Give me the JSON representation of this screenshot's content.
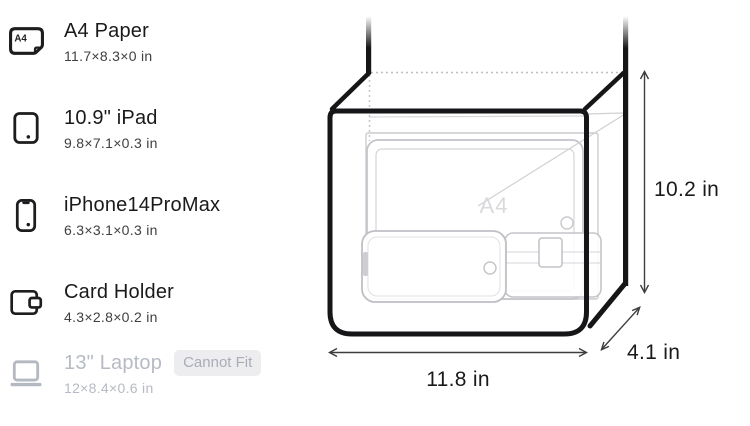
{
  "items": [
    {
      "name": "A4 Paper",
      "dims": "11.7×8.3×0 in",
      "icon_label": "A4"
    },
    {
      "name": "10.9\" iPad",
      "dims": "9.8×7.1×0.3 in"
    },
    {
      "name": "iPhone14ProMax",
      "dims": "6.3×3.1×0.3 in"
    },
    {
      "name": "Card Holder",
      "dims": "4.3×2.8×0.2 in"
    },
    {
      "name": "13\" Laptop",
      "dims": "12×8.4×0.6 in",
      "badge": "Cannot Fit"
    }
  ],
  "diagram": {
    "watermark": "A4",
    "height_label": "10.2 in",
    "width_label": "11.8 in",
    "depth_label": "4.1 in"
  },
  "colors": {
    "ink": "#161618",
    "ghost_stroke": "#c6c6cb",
    "muted_text": "#b6bac2",
    "badge_bg": "#ededf0",
    "badge_text": "#a8adb7"
  }
}
